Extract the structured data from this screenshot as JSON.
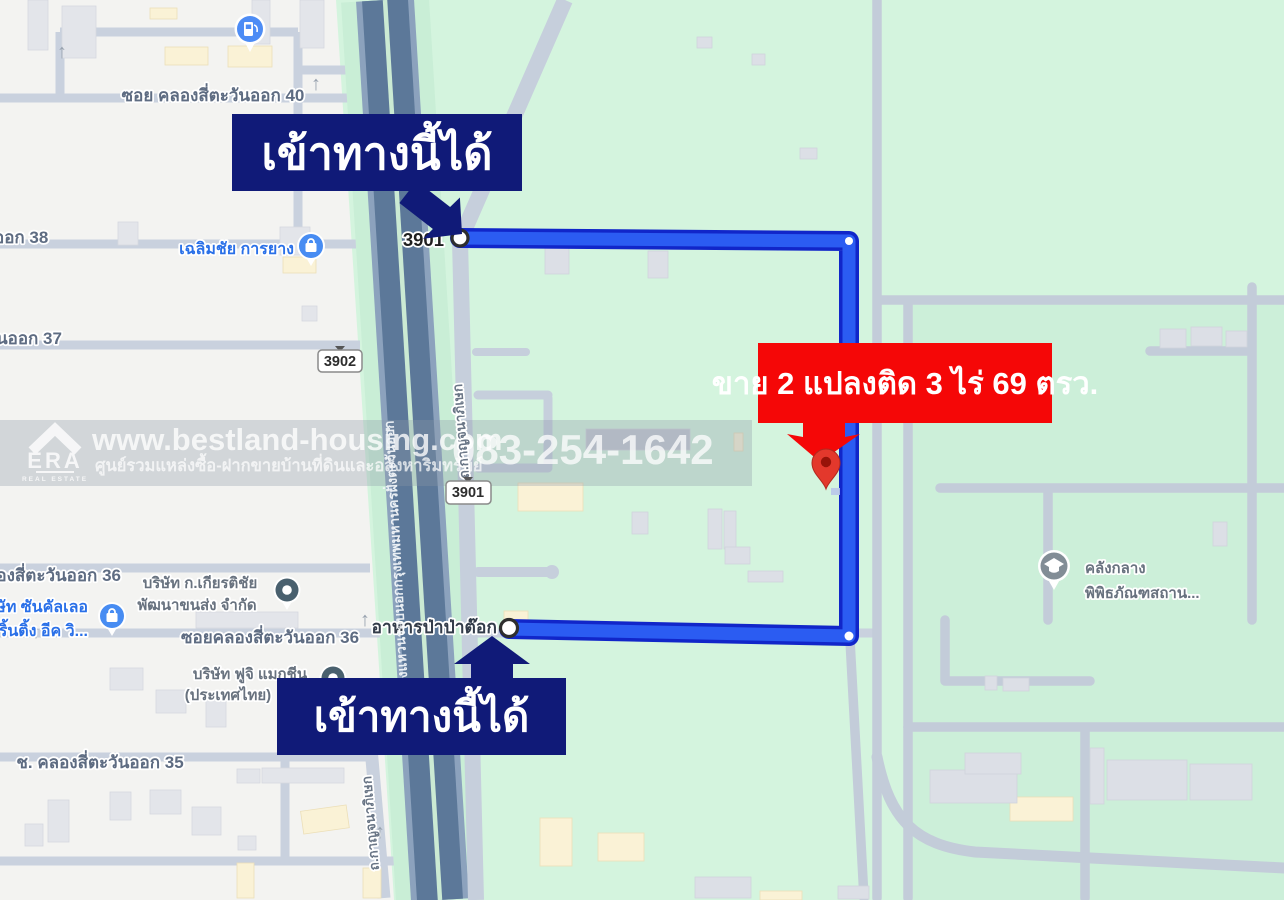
{
  "callouts": {
    "entry_top": "เข้าทางนี้ได้",
    "entry_bottom": "เข้าทางนี้ได้",
    "sale_banner": "ขาย 2 แปลงติด 3 ไร่ 69 ตรว."
  },
  "watermark": {
    "site": "www.bestland-housing.com",
    "tagline": "ศูนย์รวมแหล่งซื้อ-ฝากขายบ้านที่ดินและอสังหาริมทรัพย์",
    "phone": "083-254-1642",
    "brand": "ERA",
    "brand_sub": "REAL ESTATE"
  },
  "roads": {
    "soi_40": "ซอย คลองสี่ตะวันออก 40",
    "soi_38_partial": "ออก 38",
    "soi_37_partial": "นออก 37",
    "soi_36_partial": "ลองสี่ตะวันออก 36",
    "soi_36": "ซอยคลองสี่ตะวันออก 36",
    "soi_35": "ช. คลองสี่ตะวันออก 35",
    "ring_road": "ถนนวงแหวนรอบนอกกรุงเทพมหานครฝั่งตะวันออก",
    "kanchanaphisek": "ถ.กาญจนาภิเษก",
    "route_3901": "3901",
    "route_3902": "3902",
    "oneway_arrow": "↑"
  },
  "pois": {
    "tire_shop": "เฉลิมชัย การยาง",
    "print_shop_line1": "ษัท ซันคัลเลอ",
    "print_shop_line2": "ริ้นติ้ง อีค วิ...",
    "transport_co_line1": "บริษัท ก.เกียรติชัย",
    "transport_co_line2": "พัฒนาขนส่ง จำกัด",
    "fuji_line1": "บริษัท ฟูจิ แมกชีน",
    "fuji_line2": "(ประเทศไทย)",
    "restaurant": "อาหารป่าป่าต๊อก",
    "museum_line1": "คลังกลาง",
    "museum_line2": "พิพิธภัณฑสถาน..."
  },
  "colors": {
    "banner_navy": "#101a78",
    "banner_red": "#f50707",
    "route_blue": "#2b5cf2",
    "route_blue_dark": "#1126c9",
    "map_green": "#d4f4de",
    "urban_gray": "#f3f3f1",
    "highway_dark": "#5c7899",
    "red_pin": "#e3382c"
  }
}
